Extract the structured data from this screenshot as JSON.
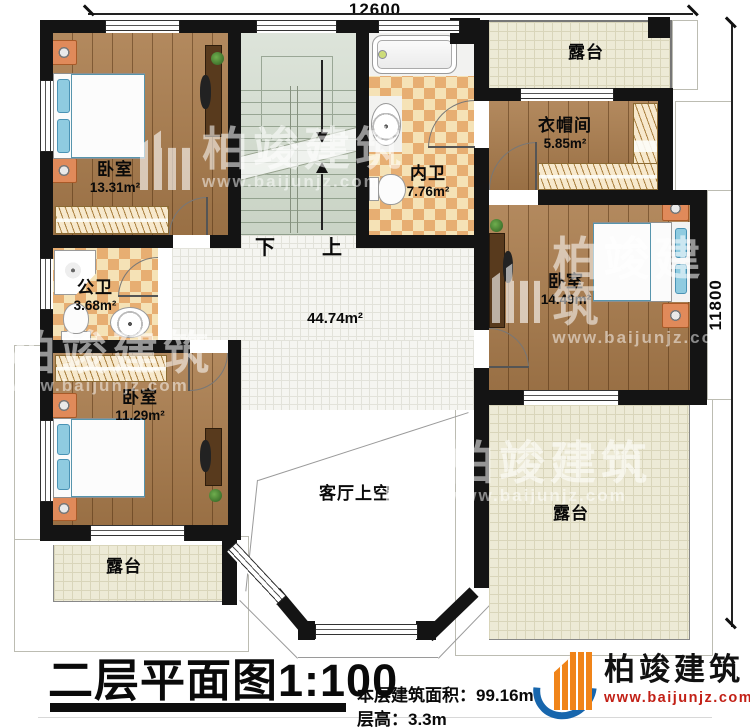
{
  "dimensions": {
    "width_label": "12600",
    "height_label": "11800"
  },
  "rooms": {
    "bedroom_top_left": {
      "name": "卧室",
      "area": "13.31m²"
    },
    "bathroom_inner": {
      "name": "内卫",
      "area": "7.76m²"
    },
    "closet": {
      "name": "衣帽间",
      "area": "5.85m²"
    },
    "bedroom_right": {
      "name": "卧室",
      "area": "14.49m²"
    },
    "bathroom_public": {
      "name": "公卫",
      "area": "3.68m²"
    },
    "bedroom_bottom_left": {
      "name": "卧室",
      "area": "11.29m²"
    },
    "hall": {
      "area": "44.74m²"
    },
    "living_void": {
      "name": "客厅上空"
    },
    "terrace_top_right": {
      "name": "露台"
    },
    "terrace_bottom_right": {
      "name": "露台"
    },
    "terrace_bottom_left": {
      "name": "露台"
    }
  },
  "stairs": {
    "down_label": "下",
    "up_label": "上"
  },
  "title_block": {
    "title": "二层平面图",
    "scale": "1:100",
    "area_line": "本层建筑面积：99.16m²",
    "height_line": "层高：3.3m"
  },
  "brand": {
    "name": "柏竣建筑",
    "url": "www.baijunjz.com"
  },
  "watermark": {
    "name": "柏竣建筑",
    "url": "www.baijunjz.com"
  },
  "colors": {
    "wall": "#141414",
    "wood": "#aa7c4c",
    "checker_light": "#f5e2b6",
    "checker_dark": "#e7ae72",
    "terrace": "#edead6",
    "stairs": "#d4dccb",
    "bed_blue": "#7fc2d8",
    "brand_orange": "#f08419",
    "brand_blue": "#1766ad",
    "url_red": "#c22016"
  }
}
